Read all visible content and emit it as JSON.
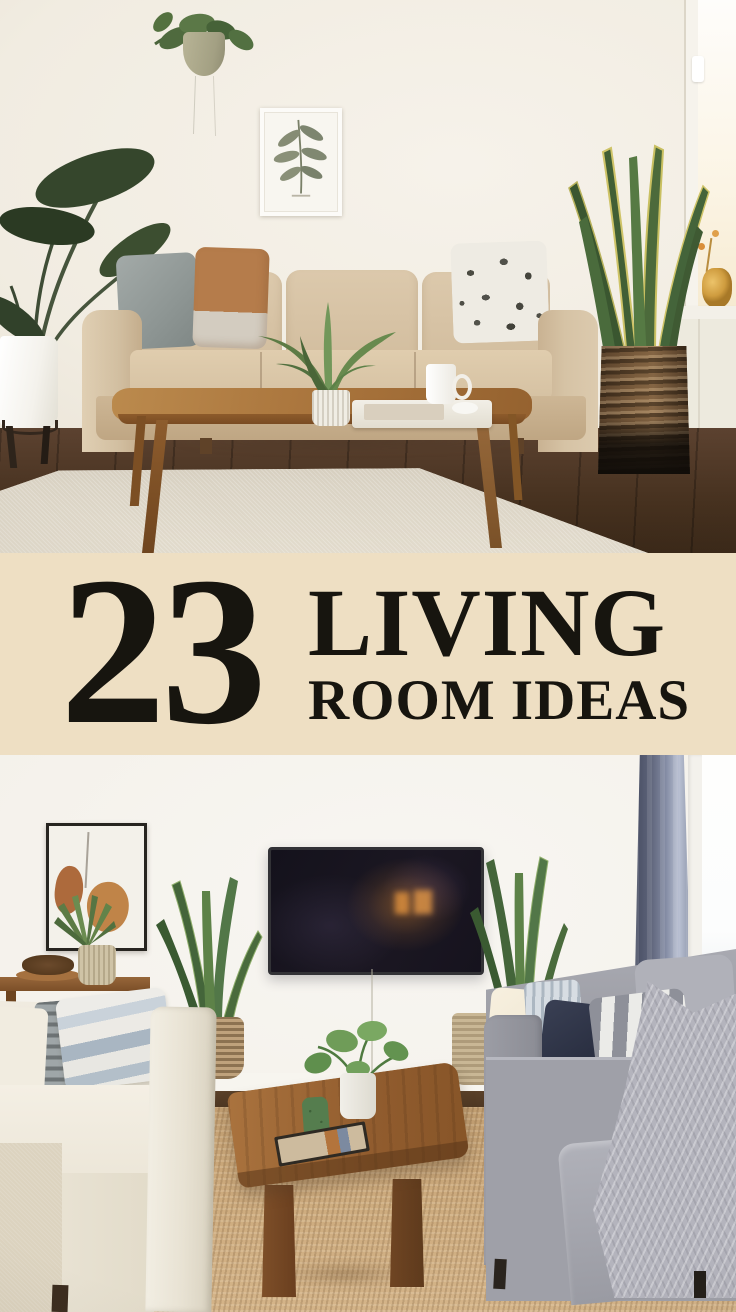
{
  "banner": {
    "count": "23",
    "title_line1": "LIVING",
    "title_line2": "ROOM IDEAS",
    "background_color": "#eedfc3",
    "text_color": "#17150f"
  },
  "photo_top": {
    "label": "beige-sofa-living-room-photo",
    "wall_color": "#f1ece2",
    "sofa_color": "#d5c1a4",
    "rug_color": "#d8d1c3",
    "floor_color": "#4a3423",
    "coffee_table_color": "#a9743c",
    "pillow_colors": [
      "#99a1a0",
      "#b57c4b",
      "#eeebe3"
    ],
    "basket_color": "#5f4830",
    "plant_color": "#35462c"
  },
  "photo_bottom": {
    "label": "tv-living-room-two-sofas-photo",
    "wall_color": "#f5f3ee",
    "white_sofa_color": "#ece6d8",
    "gray_sofa_color": "#9fa0a8",
    "navy_pillow_color": "#2c3246",
    "rug_color": "#c9a87b",
    "curtain_color": "#5d6379",
    "tv_screen_color": "#14121c",
    "coffee_table_color": "#915c2e"
  }
}
